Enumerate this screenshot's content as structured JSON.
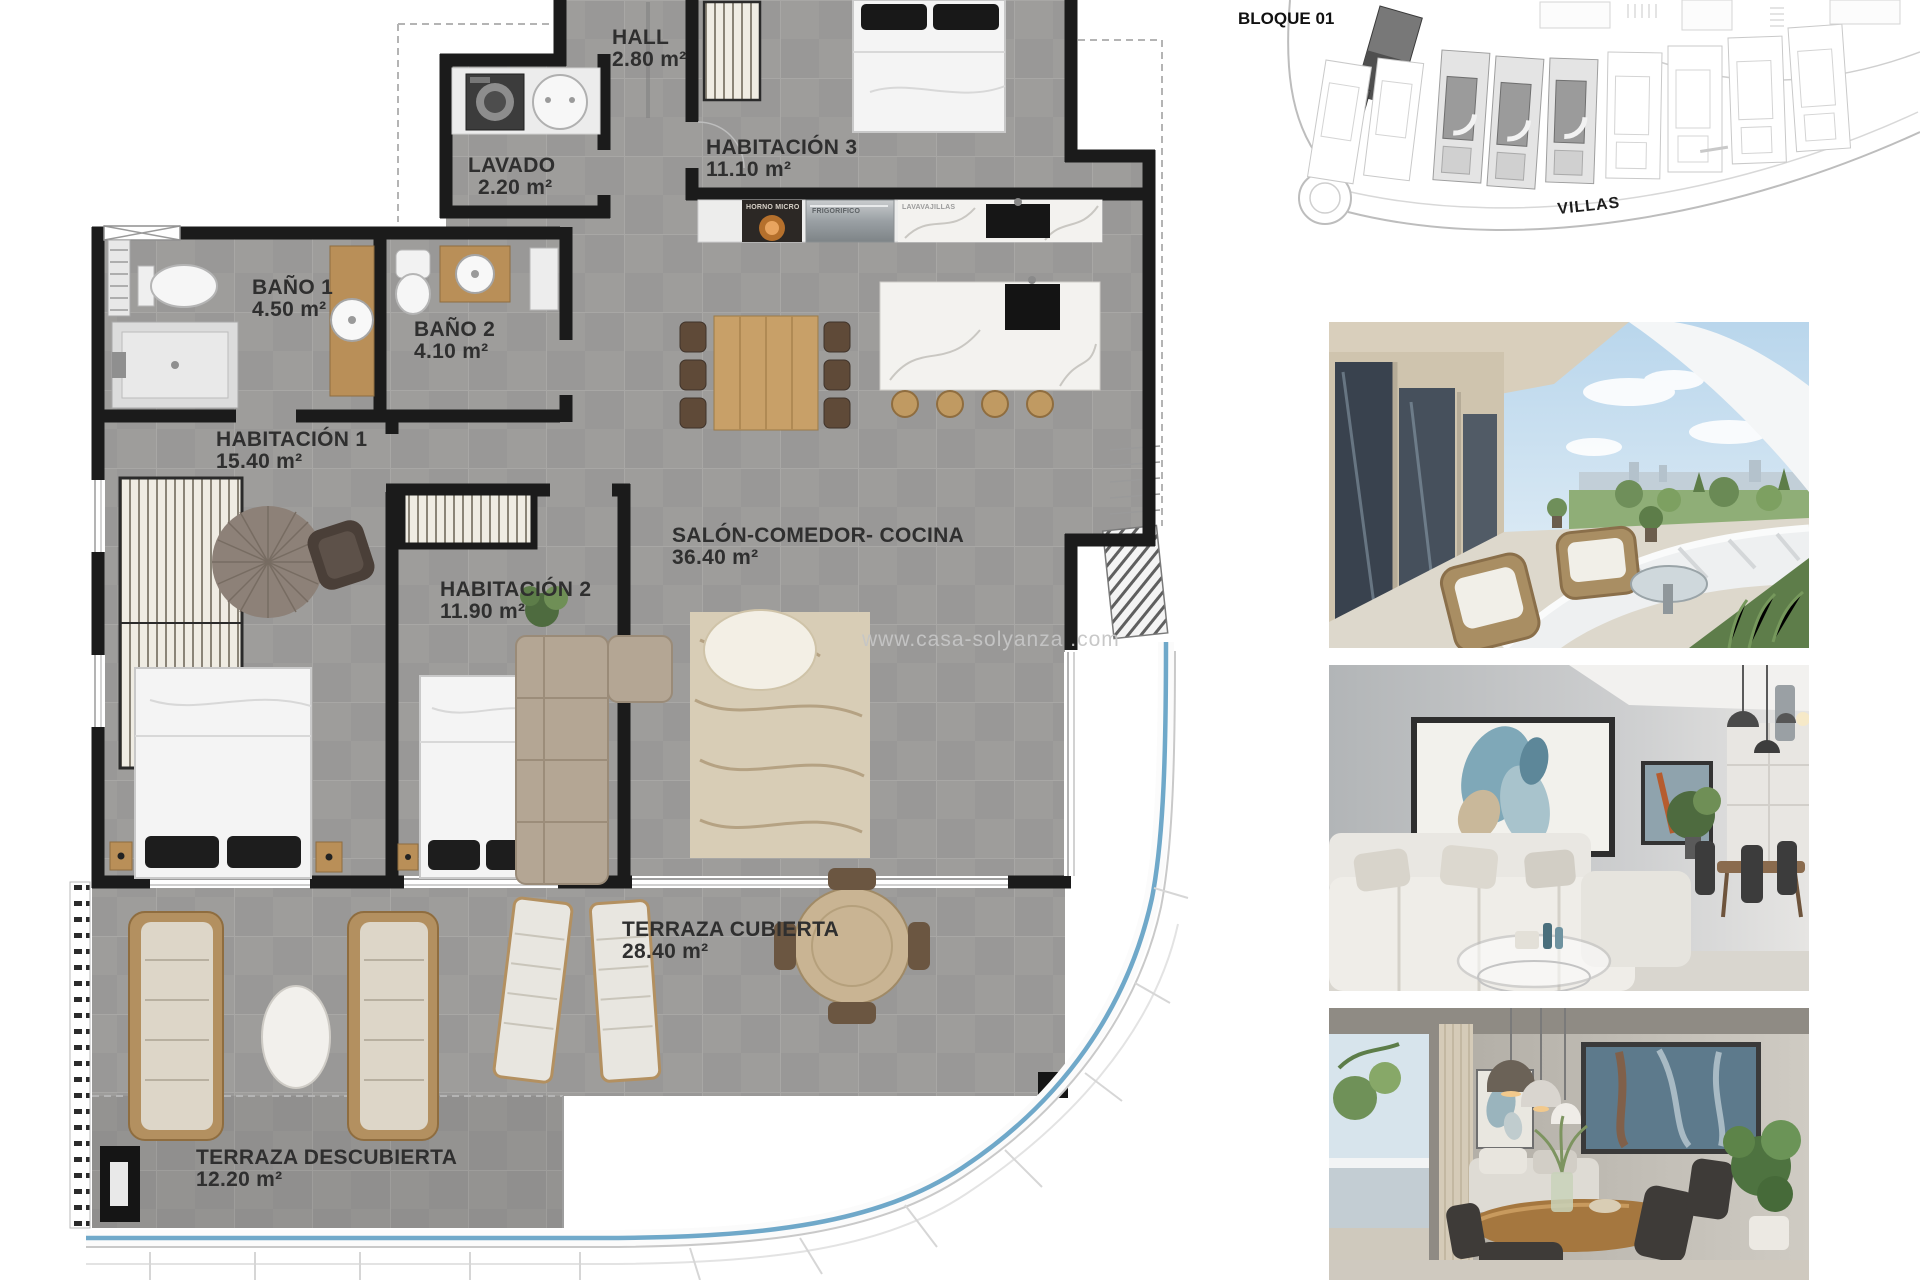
{
  "floor_plan": {
    "rooms": [
      {
        "name": "HALL",
        "area": "2.80 m²"
      },
      {
        "name": "LAVADO",
        "area": "2.20 m²"
      },
      {
        "name": "HABITACIÓN 3",
        "area": "11.10 m²"
      },
      {
        "name": "BAÑO 1",
        "area": "4.50 m²"
      },
      {
        "name": "BAÑO 2",
        "area": "4.10 m²"
      },
      {
        "name": "HABITACIÓN 1",
        "area": "15.40 m²"
      },
      {
        "name": "HABITACIÓN 2",
        "area": "11.90 m²"
      },
      {
        "name": "SALÓN-COMEDOR- COCINA",
        "area": "36.40 m²"
      },
      {
        "name": "TERRAZA CUBIERTA",
        "area": "28.40 m²"
      },
      {
        "name": "TERRAZA DESCUBIERTA",
        "area": "12.20 m²"
      }
    ],
    "appliances": [
      "HORNO MICRO",
      "FRIGORIFICO",
      "LAVAVAJILLAS"
    ],
    "watermark": "www.casa-solyanza .com"
  },
  "site_plan": {
    "block_label": "BLOQUE 01",
    "villas_label": "VILLAS"
  },
  "colors": {
    "wall_black": "#1b1b1b",
    "floor_tile_gray": "#999897",
    "wood": "#b98f58",
    "curb_blue": "#6fa8c9",
    "label_text": "#2f2f2f",
    "watermark_gray": "#c6c6c6"
  }
}
